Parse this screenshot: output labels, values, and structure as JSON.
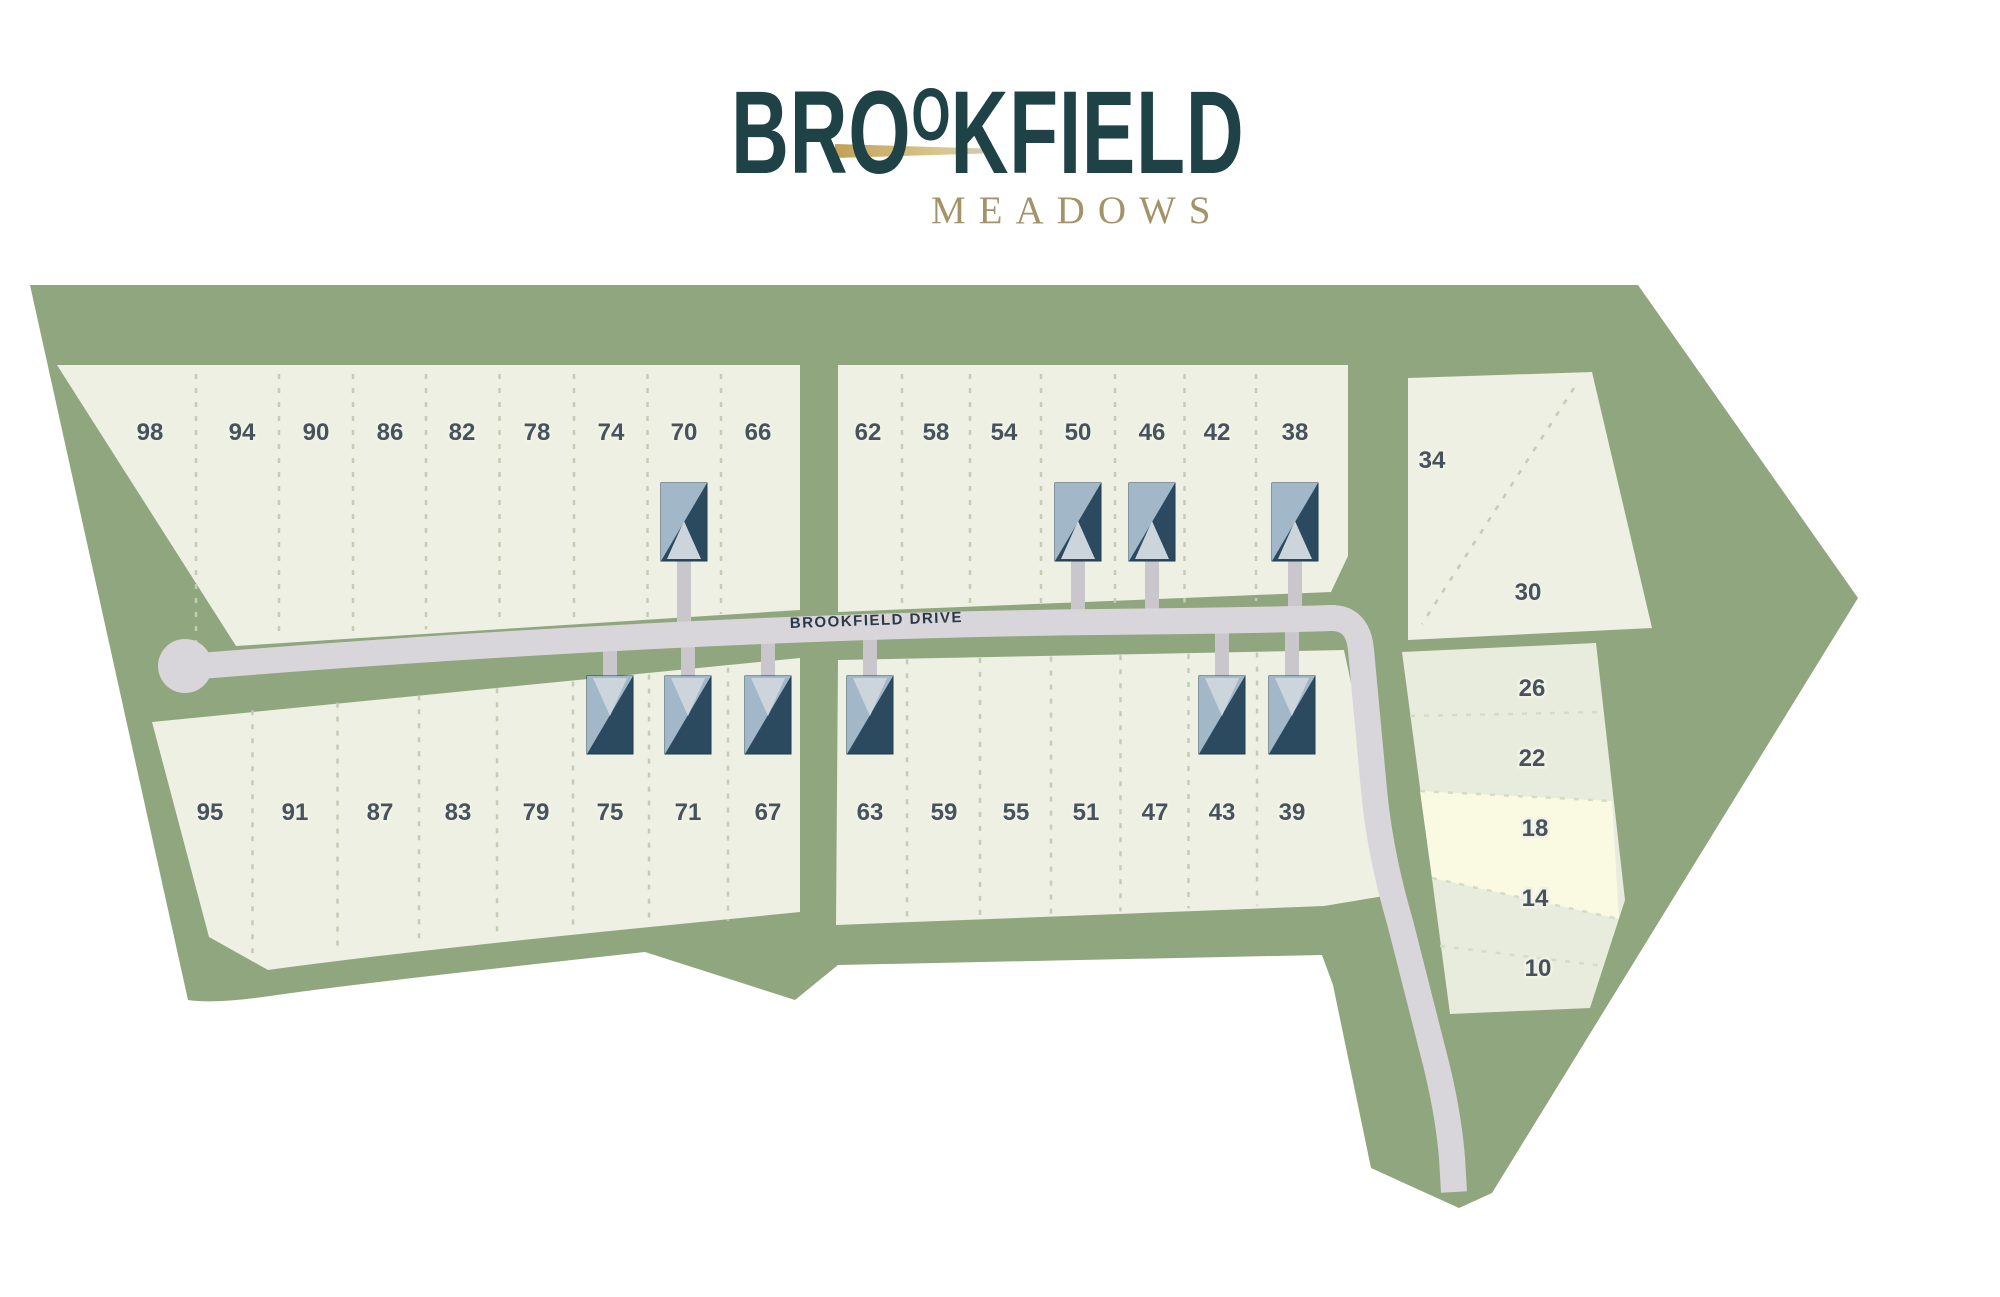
{
  "logo": {
    "title": "BROOKFIELD",
    "title_part1": "BR",
    "title_o1": "O",
    "title_o2": "O",
    "title_part2": "KFIELD",
    "subtitle": "MEADOWS",
    "title_color": "#1e4245",
    "swoosh_color": "#c2a159",
    "subtitle_color": "#a29468"
  },
  "map": {
    "road_label": "BROOKFIELD DRIVE",
    "highlighted_lot": "18",
    "colors": {
      "meadow": "#90a67f",
      "lot_block": "#edf0e2",
      "lot_block_east": "#e7ecdd",
      "lot_highlight": "#fafae3",
      "road": "#d9d6db",
      "driveway": "#c9c7cb",
      "house_dark": "#2b4a60",
      "house_light": "#a2b8c8",
      "house_gable": "#ccd5dc",
      "lot_number": "#47525c",
      "dash": "#c4ccb5"
    },
    "rows": {
      "north_west": {
        "y": 440,
        "lots": [
          {
            "n": "98",
            "x": 150
          },
          {
            "n": "94",
            "x": 242
          },
          {
            "n": "90",
            "x": 316
          },
          {
            "n": "86",
            "x": 390
          },
          {
            "n": "82",
            "x": 462
          },
          {
            "n": "78",
            "x": 537
          },
          {
            "n": "74",
            "x": 611
          },
          {
            "n": "70",
            "x": 684
          },
          {
            "n": "66",
            "x": 758
          }
        ]
      },
      "north_central": {
        "y": 440,
        "lots": [
          {
            "n": "62",
            "x": 868
          },
          {
            "n": "58",
            "x": 936
          },
          {
            "n": "54",
            "x": 1004
          },
          {
            "n": "50",
            "x": 1078
          },
          {
            "n": "46",
            "x": 1152
          },
          {
            "n": "42",
            "x": 1217
          },
          {
            "n": "38",
            "x": 1295
          }
        ]
      },
      "north_east": {
        "lots": [
          {
            "n": "34",
            "x": 1432,
            "y": 468
          },
          {
            "n": "30",
            "x": 1528,
            "y": 600
          }
        ]
      },
      "south_west": {
        "y": 820,
        "lots": [
          {
            "n": "95",
            "x": 210
          },
          {
            "n": "91",
            "x": 295
          },
          {
            "n": "87",
            "x": 380
          },
          {
            "n": "83",
            "x": 458
          },
          {
            "n": "79",
            "x": 536
          },
          {
            "n": "75",
            "x": 610
          },
          {
            "n": "71",
            "x": 688
          },
          {
            "n": "67",
            "x": 768
          }
        ]
      },
      "south_central": {
        "y": 820,
        "lots": [
          {
            "n": "63",
            "x": 870
          },
          {
            "n": "59",
            "x": 944
          },
          {
            "n": "55",
            "x": 1016
          },
          {
            "n": "51",
            "x": 1086
          },
          {
            "n": "47",
            "x": 1155
          },
          {
            "n": "43",
            "x": 1222
          },
          {
            "n": "39",
            "x": 1292
          }
        ]
      },
      "east_column": {
        "lots": [
          {
            "n": "26",
            "x": 1532,
            "y": 696
          },
          {
            "n": "22",
            "x": 1532,
            "y": 766
          },
          {
            "n": "18",
            "x": 1535,
            "y": 836
          },
          {
            "n": "14",
            "x": 1535,
            "y": 906
          },
          {
            "n": "10",
            "x": 1538,
            "y": 976
          }
        ]
      }
    },
    "houses": {
      "north_of_drive": [
        {
          "lot": "70",
          "x": 684
        },
        {
          "lot": "50",
          "x": 1078
        },
        {
          "lot": "46",
          "x": 1152
        },
        {
          "lot": "38",
          "x": 1295
        }
      ],
      "south_of_drive": [
        {
          "lot": "75",
          "x": 610
        },
        {
          "lot": "71",
          "x": 688
        },
        {
          "lot": "67",
          "x": 768
        },
        {
          "lot": "63",
          "x": 870
        },
        {
          "lot": "43",
          "x": 1222
        },
        {
          "lot": "39",
          "x": 1292
        }
      ]
    }
  }
}
